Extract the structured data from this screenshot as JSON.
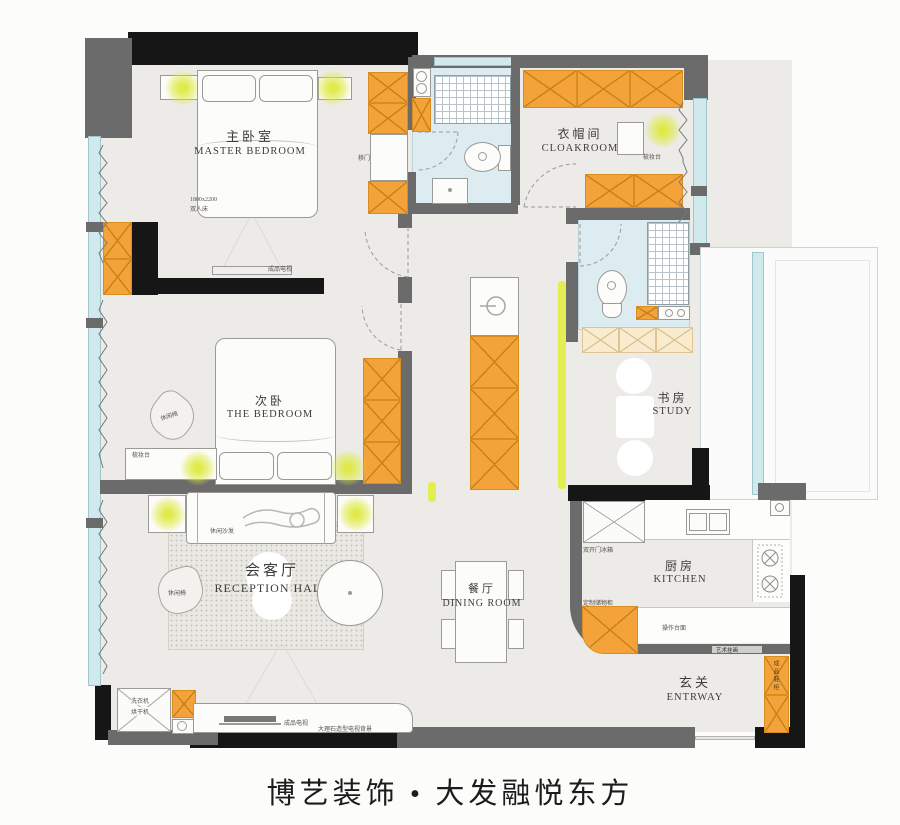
{
  "footer": {
    "title": "博艺装饰 • 大发融悦东方"
  },
  "rooms": {
    "master_bedroom": {
      "cn": "主卧室",
      "en": "MASTER BEDROOM"
    },
    "cloakroom": {
      "cn": "衣帽间",
      "en": "CLOAKROOM"
    },
    "second_bedroom": {
      "cn": "次卧",
      "en": "THE BEDROOM"
    },
    "study": {
      "cn": "书房",
      "en": "STUDY"
    },
    "reception_hall": {
      "cn": "会客厅",
      "en": "RECEPTION HALL"
    },
    "dining_room": {
      "cn": "餐厅",
      "en": "DINING ROOM"
    },
    "kitchen": {
      "cn": "厨房",
      "en": "KITCHEN"
    },
    "entryway": {
      "cn": "玄关",
      "en": "ENTRWAY"
    }
  },
  "annotations": {
    "bed_size": "1800x2200",
    "bed_type": "双人床",
    "tv_master": "成品电视",
    "sliding_door": "移门",
    "dresser_cloakroom": "梳妆台",
    "chair_bedroom": "休闲椅",
    "dresser_bedroom": "梳妆台",
    "sofa": "休闲沙发",
    "chair_hall": "休闲椅",
    "washer": "洗衣机",
    "dryer": "烘干机",
    "tv_hall": "成品电视",
    "tv_wall": "大理石造型电视背景",
    "fridge": "双开门冰箱",
    "storage_cabinet": "定制储物柜",
    "countertop": "操作台面",
    "art_frame": "艺术挂画",
    "shoe_cabinet": "成品鞋柜"
  },
  "colors": {
    "cabinet_orange": "#f3a33a",
    "cabinet_line": "#c9801a",
    "wall_gray": "#6b6b6b",
    "wall_black": "#161616",
    "window_cyan": "#cfe9ec",
    "bath_floor": "#dcecf1",
    "floor": "#edebe7",
    "accent_light": "#e3ee55",
    "lamp_glow": "#dce93f"
  }
}
